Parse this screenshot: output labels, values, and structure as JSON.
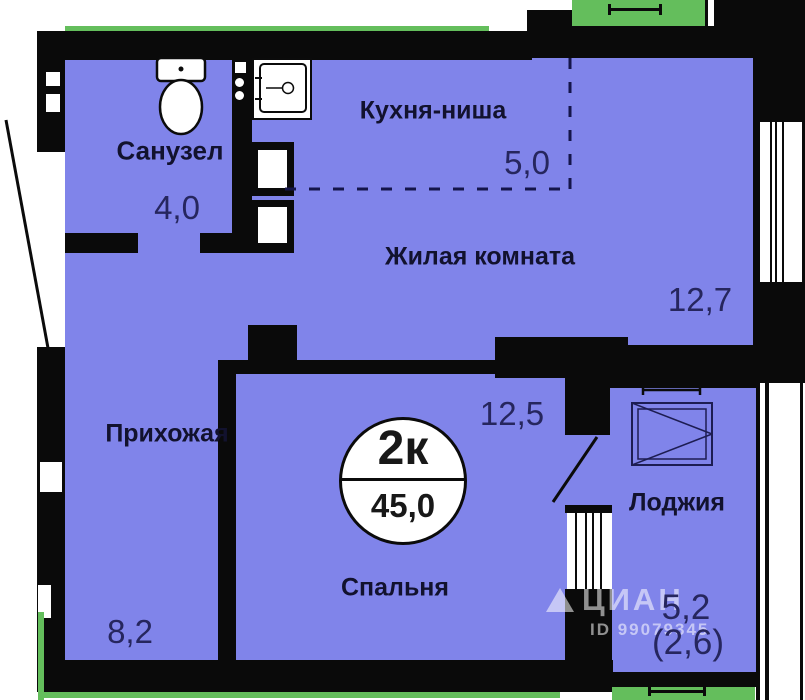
{
  "badge": {
    "rooms": "2к",
    "total_area": "45,0"
  },
  "rooms": {
    "sanuzel": {
      "name": "Санузел",
      "area": "4,0"
    },
    "kitchen": {
      "name": "Кухня-ниша",
      "area": "5,0"
    },
    "living": {
      "name": "Жилая комната",
      "area": "12,7"
    },
    "bedroom": {
      "name": "Спальня",
      "area": "12,5"
    },
    "hall": {
      "name": "Прихожая",
      "area": "8,2"
    },
    "loggia": {
      "name": "Лоджия",
      "area": "5,2",
      "area_coeff": "(2,6)"
    }
  },
  "watermark": {
    "brand": "ЦИАН",
    "listing_id": "ID 99079345"
  },
  "colors": {
    "floor": "#8084EA",
    "wall": "#0A0A0A",
    "balcony": "#64BE5C",
    "number_text": "#26265E",
    "label_text": "#12122E"
  }
}
